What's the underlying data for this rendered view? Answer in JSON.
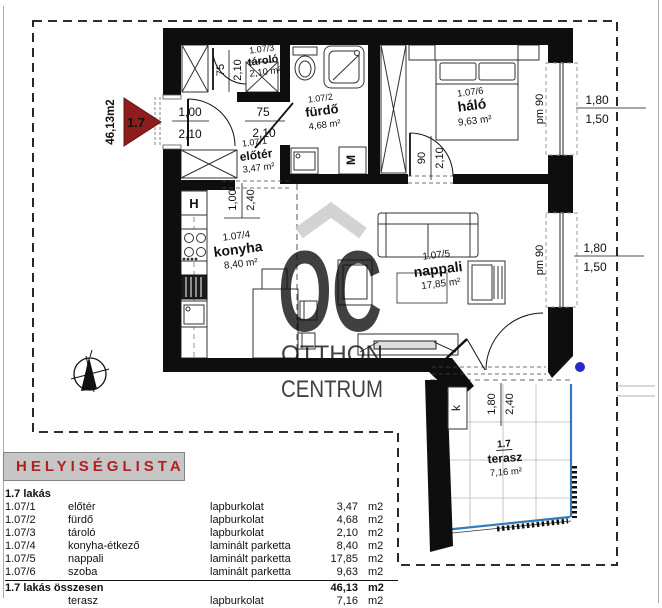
{
  "plan": {
    "unit": {
      "area_label": "46,13m2",
      "marker": "1.7"
    },
    "rooms": {
      "tarolo": {
        "code": "1.07/3",
        "name": "tároló",
        "area": "2,10 m²"
      },
      "furdo": {
        "code": "1.07/2",
        "name": "fürdő",
        "area": "4,68 m²"
      },
      "eloter": {
        "code": "1.07/1",
        "name": "előtér",
        "area": "3,47 m²"
      },
      "halo": {
        "code": "1.07/6",
        "name": "háló",
        "area": "9,63 m²"
      },
      "konyha": {
        "code": "1.07/4",
        "name": "konyha",
        "area": "8,40 m²"
      },
      "nappali": {
        "code": "1.07/5",
        "name": "nappali",
        "area": "17,85 m²"
      },
      "terasz": {
        "code": "1.7",
        "name": "terasz",
        "area": "7,16 m²"
      }
    },
    "dims": {
      "entry_w": "1,00",
      "entry_h": "2,10",
      "tarolo_w": "75",
      "tarolo_h": "2,10",
      "furdo_w": "75",
      "furdo_h": "2,10",
      "halo_w": "90",
      "halo_h": "2,10",
      "pass_w": "1,00",
      "pass_h": "2,40",
      "window_sill": "pm 90",
      "window_w": "1,80",
      "window_h": "1,50",
      "terrace_w": "1,80",
      "terrace_h": "2,40"
    },
    "marks": {
      "fridge": "H",
      "washer": "M",
      "terrace": "k"
    }
  },
  "watermark": {
    "monogram": "OC",
    "line1": "OTTHON",
    "line2": "CENTRUM"
  },
  "room_list": {
    "title": "HELYISÉGLISTA",
    "group": "1.7 lakás",
    "rows": [
      {
        "code": "1.07/1",
        "name": "előtér",
        "material": "lapburkolat",
        "value": "3,47",
        "unit": "m2"
      },
      {
        "code": "1.07/2",
        "name": "fürdő",
        "material": "lapburkolat",
        "value": "4,68",
        "unit": "m2"
      },
      {
        "code": "1.07/3",
        "name": "tároló",
        "material": "lapburkolat",
        "value": "2,10",
        "unit": "m2"
      },
      {
        "code": "1.07/4",
        "name": "konyha-étkező",
        "material": "laminált parketta",
        "value": "8,40",
        "unit": "m2"
      },
      {
        "code": "1.07/5",
        "name": "nappali",
        "material": "laminált parketta",
        "value": "17,85",
        "unit": "m2"
      },
      {
        "code": "1.07/6",
        "name": "szoba",
        "material": "laminált parketta",
        "value": "9,63",
        "unit": "m2"
      }
    ],
    "total": {
      "label": "1.7 lakás összesen",
      "value": "46,13",
      "unit": "m2"
    },
    "extra": {
      "name": "terasz",
      "material": "lapburkolat",
      "value": "7,16",
      "unit": "m2"
    }
  },
  "colors": {
    "accent_red": "#b51f1f",
    "marker_red": "#8b1d1d",
    "watermark_gray": "#c9c9c9",
    "terrace_blue": "#3579b8",
    "dot_blue": "#2929c8"
  }
}
